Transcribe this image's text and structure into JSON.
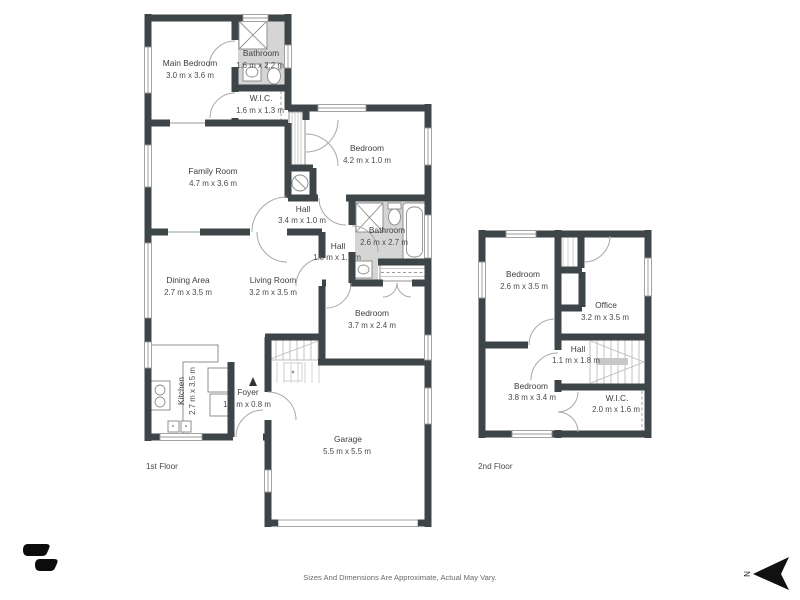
{
  "floors": {
    "first": {
      "label": "1st Floor",
      "rooms": {
        "main_bedroom": {
          "name": "Main Bedroom",
          "dims": "3.0 m x 3.6 m"
        },
        "bathroom": {
          "name": "Bathroom",
          "dims": "1.6 m x 2.2 m"
        },
        "wic": {
          "name": "W.I.C.",
          "dims": "1.6 m x 1.3 m"
        },
        "family_room": {
          "name": "Family Room",
          "dims": "4.7 m x 3.6 m"
        },
        "bedroom_top": {
          "name": "Bedroom",
          "dims": "4.2 m x 1.0 m"
        },
        "hall_upper": {
          "name": "Hall",
          "dims": "3.4 m x 1.0 m"
        },
        "bathroom_main": {
          "name": "Bathroom",
          "dims": "2.6 m x 2.7 m"
        },
        "hall_lower": {
          "name": "Hall",
          "dims": "1.0 m x 1.7 m"
        },
        "dining_area": {
          "name": "Dining Area",
          "dims": "2.7 m x 3.5 m"
        },
        "living_room": {
          "name": "Living Room",
          "dims": "3.2 m x 3.5 m"
        },
        "bedroom_mid": {
          "name": "Bedroom",
          "dims": "3.7 m x 2.4 m"
        },
        "kitchen": {
          "name": "Kitchen",
          "dims": "2.7 m x 3.5 m"
        },
        "foyer": {
          "name": "Foyer",
          "dims": "1.4 m x 0.8 m"
        },
        "garage": {
          "name": "Garage",
          "dims": "5.5 m x 5.5 m"
        }
      }
    },
    "second": {
      "label": "2nd Floor",
      "rooms": {
        "bedroom_upper": {
          "name": "Bedroom",
          "dims": "2.6 m x 3.5 m"
        },
        "office": {
          "name": "Office",
          "dims": "3.2 m x 3.5 m"
        },
        "hall": {
          "name": "Hall",
          "dims": "1.1 m x 1.8 m"
        },
        "bedroom_lower": {
          "name": "Bedroom",
          "dims": "3.8 m x 3.4 m"
        },
        "wic": {
          "name": "W.I.C.",
          "dims": "2.0 m x 1.6 m"
        }
      }
    }
  },
  "footer": {
    "disclaimer": "Sizes And Dimensions Are Approximate, Actual May Vary."
  },
  "compass": {
    "label": "N"
  },
  "colors": {
    "wall": "#3e4549",
    "bathroom_floor": "#d5d5d5",
    "background": "#ffffff"
  }
}
